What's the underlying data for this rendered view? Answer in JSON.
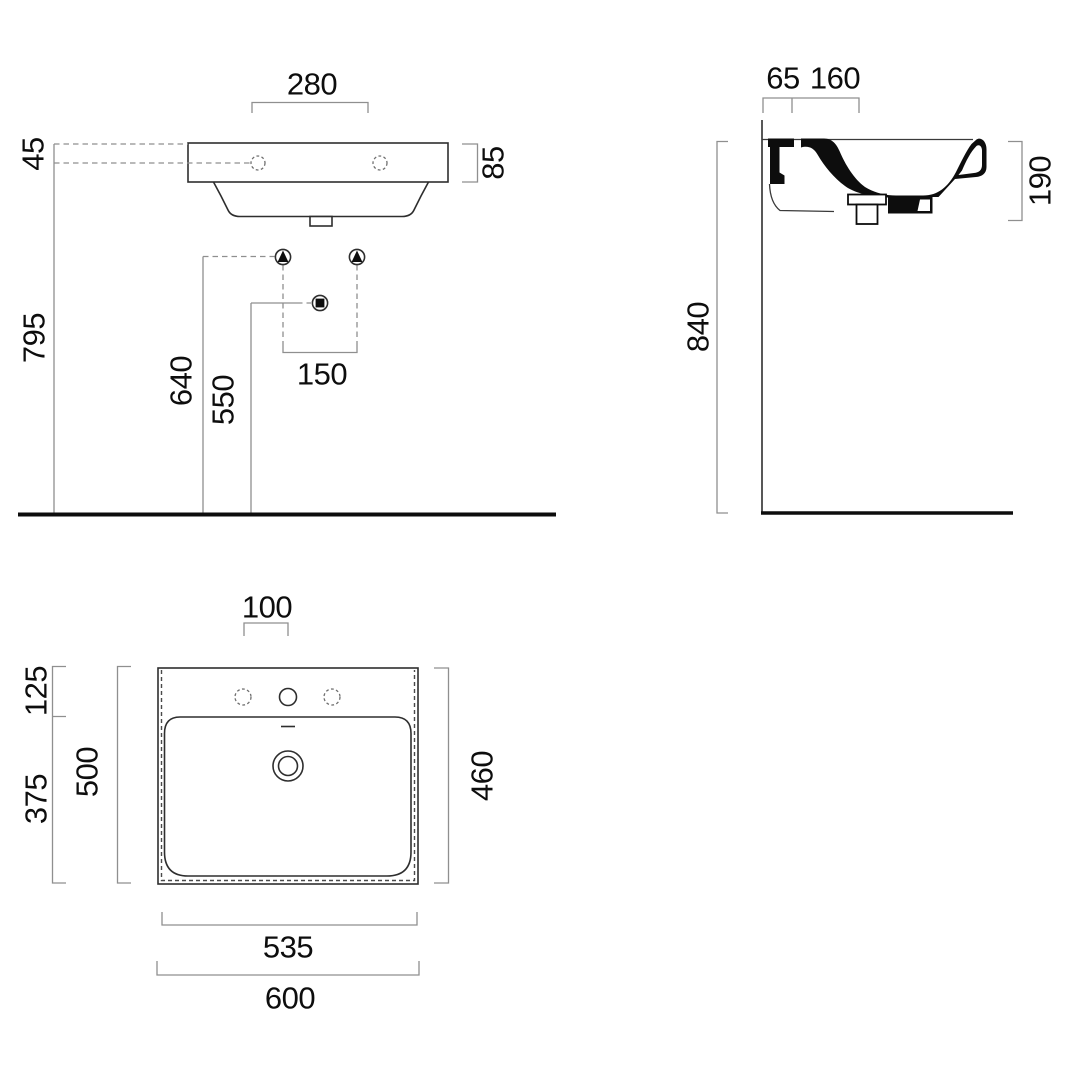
{
  "drawing_type": "washbasin technical dimensions, three orthographic views",
  "colors": {
    "background": "#ffffff",
    "ink": "#0d0d0d",
    "drawing_line": "#2e2e2e",
    "dimension_line": "#8f8f8f"
  },
  "labels": {
    "front": {
      "tap_hole_spacing": "280",
      "rim_top_offset": "45",
      "rim_height": "85",
      "total_height": "795",
      "bracket_height": "640",
      "drain_outlet_height": "550",
      "fixing_spacing": "150"
    },
    "side": {
      "wall_offset": "65",
      "fixing_depth": "160",
      "basin_depth": "190",
      "mounting_height": "840"
    },
    "plan": {
      "tap_hole_spacing": "100",
      "back_ledge_depth": "125",
      "bowl_depth": "375",
      "bowl_total_depth": "500",
      "overall_depth": "460",
      "inner_width": "535",
      "overall_width": "600"
    }
  },
  "icons": {
    "wall_fixing_marker": "circled filled triangle",
    "drain_marker": "circled filled square"
  }
}
